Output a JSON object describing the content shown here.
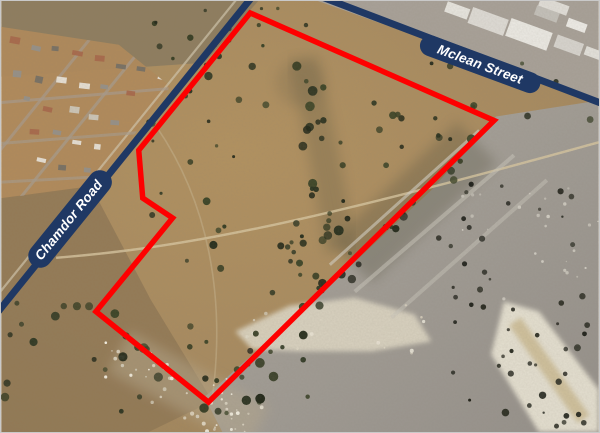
{
  "map": {
    "kind": "aerial-satellite-figure",
    "roads": [
      {
        "id": "chamdor-road",
        "label": "Chamdor Road",
        "color": "#1f3864",
        "label_color": "#ffffff",
        "path": "M255,-8 L-8,318",
        "pill_path": "M39,256 L99,182",
        "pill_width": 24,
        "label_transform": "translate(67.5,220) rotate(-51)"
      },
      {
        "id": "mclean-street",
        "label": "Mclean Street",
        "color": "#1f3864",
        "label_color": "#ffffff",
        "path": "M322,-4 L606,104",
        "pill_path": "M431,45 L531,82",
        "pill_width": 21,
        "label_transform": "translate(481,63.5) rotate(20.3)"
      }
    ],
    "boundary": {
      "id": "site-boundary",
      "color": "#fe0000",
      "stroke_width": 5.5,
      "points": "250,12 495,120 208,403 95,312 172,218 142,198 138,150"
    }
  }
}
